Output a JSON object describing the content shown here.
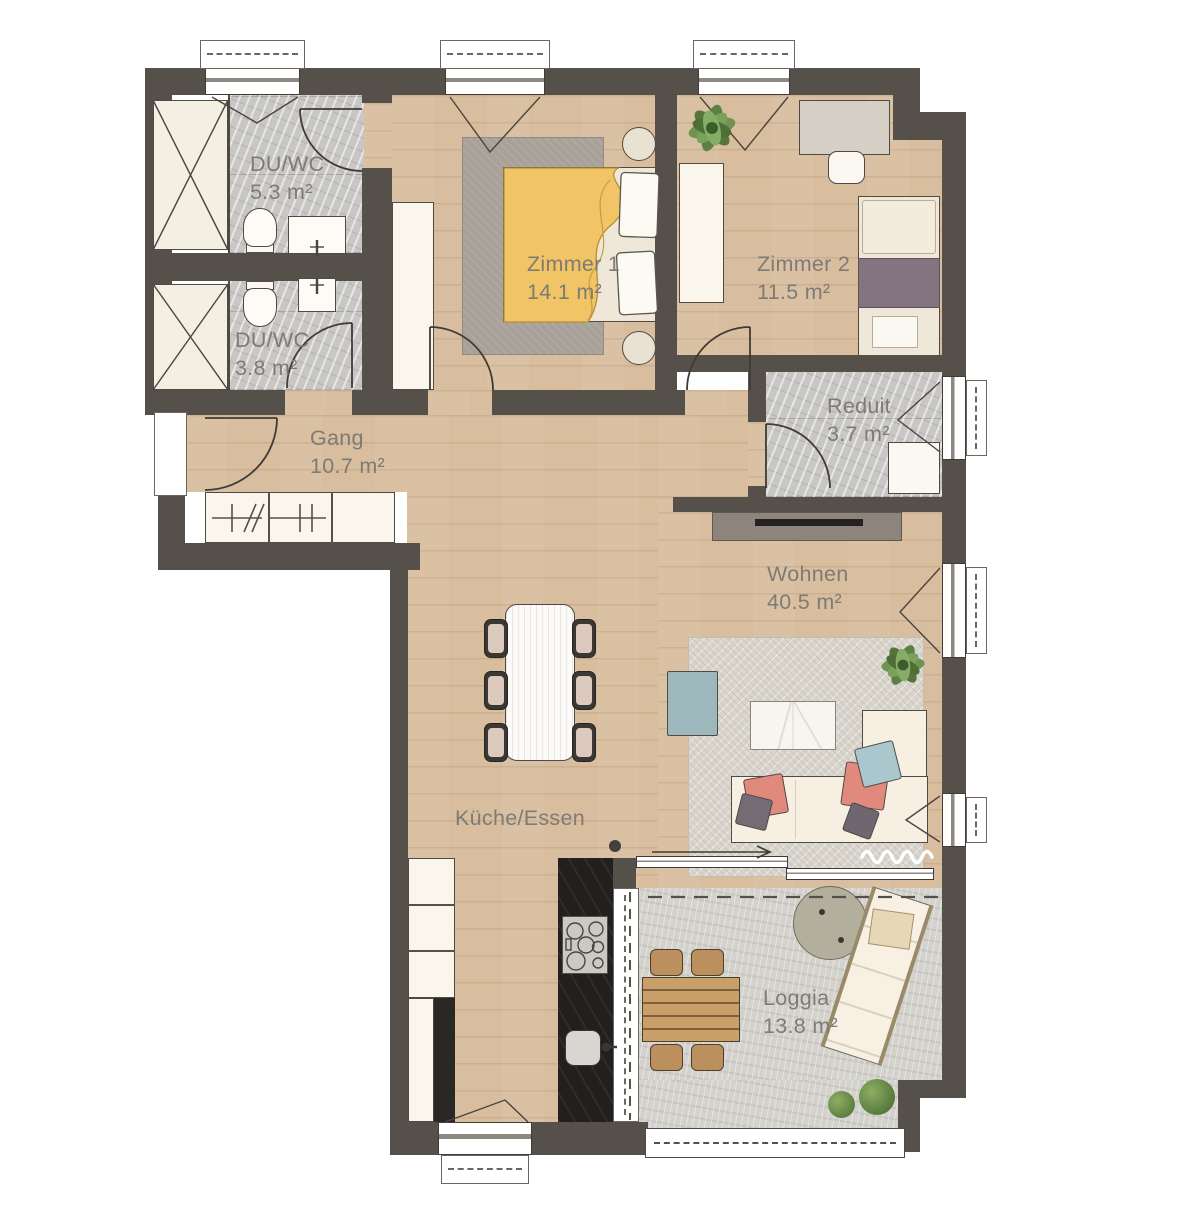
{
  "plan": {
    "type": "apartment-floor-plan",
    "rooms": [
      {
        "id": "duwc-top",
        "name": "DU/WC",
        "area": "5.3 m²"
      },
      {
        "id": "duwc-bottom",
        "name": "DU/WC",
        "area": "3.8 m²"
      },
      {
        "id": "zimmer-1",
        "name": "Zimmer 1",
        "area": "14.1 m²"
      },
      {
        "id": "zimmer-2",
        "name": "Zimmer 2",
        "area": "11.5 m²"
      },
      {
        "id": "reduit",
        "name": "Reduit",
        "area": "3.7 m²"
      },
      {
        "id": "gang",
        "name": "Gang",
        "area": "10.7 m²"
      },
      {
        "id": "wohnen",
        "name": "Wohnen",
        "area": "40.5 m²"
      },
      {
        "id": "kueche",
        "name": "Küche/Essen",
        "area": ""
      },
      {
        "id": "loggia",
        "name": "Loggia",
        "area": "13.8 m²"
      }
    ],
    "theme": {
      "wall": "#56504a",
      "wood": "#d8bd9e",
      "tile": "#c8c7c5",
      "concrete": "#d4d2cd",
      "rugDark": "#a8a19a",
      "rugLight": "#d9d5cd",
      "cream": "#f6efe2",
      "yellow": "#f1c566",
      "purple": "#83747f",
      "blue": "#9db8bc",
      "pink": "#e2897e",
      "pillowBlue": "#aac7cd",
      "counter": "#22201e",
      "green": "#6a8a4f",
      "label": "#7e7b76"
    }
  }
}
